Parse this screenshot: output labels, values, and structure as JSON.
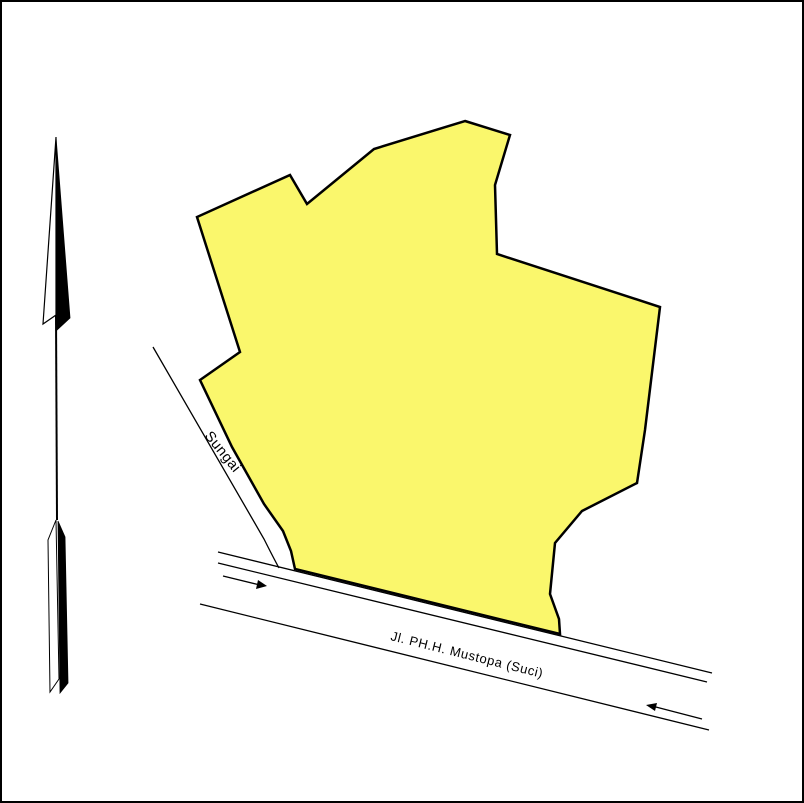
{
  "frame": {
    "background": "#ffffff",
    "border_color": "#000000"
  },
  "parcel": {
    "fill": "#faf76c",
    "stroke": "#000000",
    "points": "463,119 508,133 493,183 495,252 658,305 643,428 635,481 580,509 553,541 548,592 557,617 558,632 293,567 289,549 281,529 262,502 230,445 198,378 238,350 195,215 288,173 305,202 372,147"
  },
  "river": {
    "label": "Sungai",
    "bank_path": "M151,345 L262,537 Q271,555 277,566"
  },
  "road": {
    "label": "Jl. PH.H. Mustopa (Suci)",
    "top_edge_outer": "M216,550 L710,671",
    "top_edge_inner": "M216,561 L705,680",
    "bottom_edge": "M198,602 L707,728",
    "arrow_right_shaft": "M221,574 L258,583",
    "arrow_right_head": "265,584 254,587 256,578",
    "arrow_left_shaft": "M700,717 L650,704",
    "arrow_left_head": "644,703 655,701 653,709"
  },
  "north_arrow": {
    "color": "#000000",
    "head_white_points": "54,135 41,322 54,313",
    "head_black_points": "54,135 68,316 55,328 54,313",
    "shaft_path": "M54,313 L55,518",
    "tail_white_points": "54,518 46,538 48,690 57,677",
    "tail_black_points": "56,519 63,535 66,681 58,691"
  }
}
